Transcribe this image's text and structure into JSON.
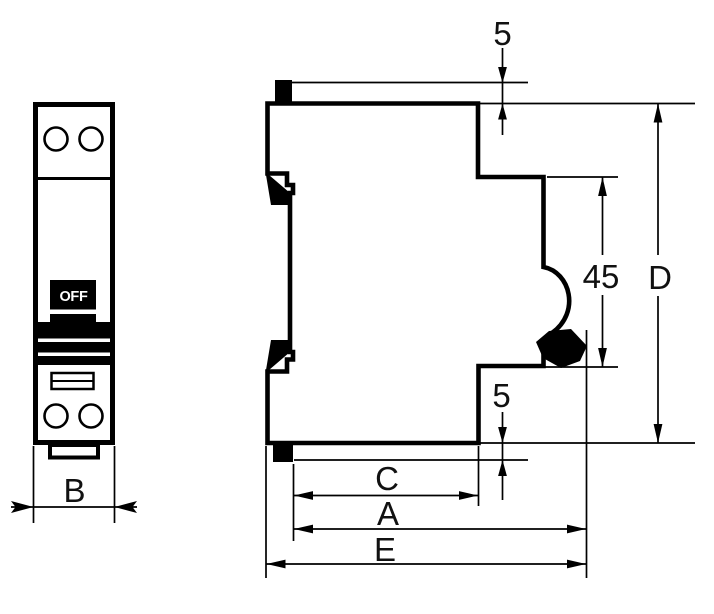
{
  "front": {
    "toggle_label": "OFF",
    "dim_width": "B"
  },
  "side": {
    "dim_top_offset": "5",
    "dim_rail_height": "45",
    "dim_overall_height": "D",
    "dim_bottom_offset": "5",
    "dim_c": "C",
    "dim_a": "A",
    "dim_e": "E"
  },
  "colors": {
    "ink": "#000000",
    "paper": "#ffffff",
    "label": "#111111"
  }
}
